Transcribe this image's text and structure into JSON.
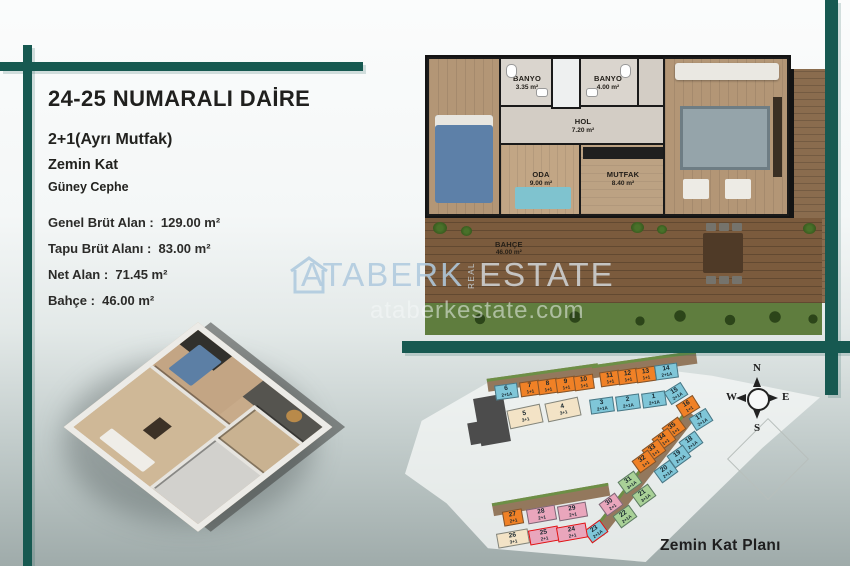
{
  "header": {
    "title": "24-25 NUMARALI DAİRE",
    "subtitle1": "2+1(Ayrı Mutfak)",
    "subtitle2": "Zemin Kat",
    "subtitle3": "Güney Cephe",
    "details": [
      {
        "label": "Genel Brüt Alan",
        "value": "129.00 m²"
      },
      {
        "label": "Tapu Brüt Alanı",
        "value": "83.00 m²"
      },
      {
        "label": "Net Alan",
        "value": "71.45 m²"
      },
      {
        "label": "Bahçe",
        "value": "46.00 m²"
      }
    ]
  },
  "colors": {
    "accent_teal": "#175951",
    "unit_teal": "#7fc6d8",
    "unit_orange": "#f08126",
    "unit_beige": "#f3e3c6",
    "unit_green": "#a9d197",
    "unit_pink": "#e9a6bc",
    "highlight_red": "#e01212"
  },
  "floor_plan": {
    "rooms": [
      {
        "name": "YATAK ODASI",
        "area": "17.90 m²",
        "floor": "wood",
        "x": 0,
        "y": 0,
        "w": 72,
        "h": 155
      },
      {
        "name": "BANYO",
        "area": "3.35 m²",
        "floor": "tile",
        "x": 72,
        "y": 0,
        "w": 52,
        "h": 48
      },
      {
        "name": "BANYO",
        "area": "4.00 m²",
        "floor": "tile",
        "x": 150,
        "y": 0,
        "w": 58,
        "h": 48
      },
      {
        "name": "HOL",
        "area": "7.20 m²",
        "floor": "hall",
        "x": 72,
        "y": 48,
        "w": 164,
        "h": 38
      },
      {
        "name": "ODA",
        "area": "9.00 m²",
        "floor": "wood2",
        "x": 72,
        "y": 86,
        "w": 80,
        "h": 69
      },
      {
        "name": "MUTFAK",
        "area": "8.40 m²",
        "floor": "kitchen",
        "x": 152,
        "y": 86,
        "w": 84,
        "h": 69
      },
      {
        "name": "SALON",
        "area": "21.60 m²",
        "floor": "wood",
        "x": 236,
        "y": 0,
        "w": 122,
        "h": 155
      }
    ],
    "garden": {
      "name": "BAHÇE",
      "area": "46.00 m²"
    }
  },
  "watermark": {
    "brand1": "ATABERK",
    "vertical": "REAL",
    "brand2": "ESTATE",
    "domain": "ataberkestate.com"
  },
  "site_plan": {
    "caption": "Zemin Kat Planı",
    "compass": {
      "n": "N",
      "e": "E",
      "s": "S",
      "w": "W"
    },
    "units": [
      {
        "num": "6",
        "type": "2+1A",
        "c": "teal",
        "x": 495,
        "y": 384,
        "r": -8,
        "w": 23
      },
      {
        "num": "7",
        "type": "1+1",
        "c": "orange",
        "x": 520,
        "y": 381,
        "r": -8
      },
      {
        "num": "8",
        "type": "1+1",
        "c": "orange",
        "x": 538,
        "y": 379,
        "r": -8
      },
      {
        "num": "9",
        "type": "1+1",
        "c": "orange",
        "x": 556,
        "y": 377,
        "r": -8
      },
      {
        "num": "10",
        "type": "1+1",
        "c": "orange",
        "x": 574,
        "y": 375,
        "r": -8
      },
      {
        "num": "11",
        "type": "1+1",
        "c": "orange",
        "x": 600,
        "y": 371,
        "r": -8
      },
      {
        "num": "12",
        "type": "1+1",
        "c": "orange",
        "x": 618,
        "y": 369,
        "r": -8
      },
      {
        "num": "13",
        "type": "1+1",
        "c": "orange",
        "x": 636,
        "y": 367,
        "r": -8
      },
      {
        "num": "14",
        "type": "2+1A",
        "c": "teal",
        "x": 655,
        "y": 364,
        "r": -8,
        "w": 23
      },
      {
        "num": "3",
        "type": "2+1A",
        "c": "teal",
        "x": 590,
        "y": 398,
        "r": -8,
        "w": 24
      },
      {
        "num": "2",
        "type": "2+1A",
        "c": "teal",
        "x": 616,
        "y": 395,
        "r": -8,
        "w": 24
      },
      {
        "num": "1",
        "type": "2+1A",
        "c": "teal",
        "x": 642,
        "y": 392,
        "r": -8,
        "w": 24
      },
      {
        "num": "5",
        "type": "3+1",
        "c": "beige",
        "x": 508,
        "y": 407,
        "r": -12,
        "w": 34,
        "h": 19
      },
      {
        "num": "4",
        "type": "3+1",
        "c": "beige",
        "x": 546,
        "y": 400,
        "r": -12,
        "w": 34,
        "h": 19
      },
      {
        "num": "15",
        "type": "2+1A",
        "c": "teal",
        "x": 666,
        "y": 386,
        "r": -32
      },
      {
        "num": "16",
        "type": "1+1",
        "c": "orange",
        "x": 678,
        "y": 399,
        "r": -32
      },
      {
        "num": "17",
        "type": "2+1A",
        "c": "teal",
        "x": 691,
        "y": 412,
        "r": -32
      },
      {
        "num": "35",
        "type": "1+1",
        "c": "orange",
        "x": 664,
        "y": 421,
        "r": -36
      },
      {
        "num": "34",
        "type": "1+1",
        "c": "orange",
        "x": 654,
        "y": 432,
        "r": -36
      },
      {
        "num": "33",
        "type": "1+1",
        "c": "orange",
        "x": 644,
        "y": 443,
        "r": -36
      },
      {
        "num": "32",
        "type": "1+1",
        "c": "orange",
        "x": 634,
        "y": 454,
        "r": -36
      },
      {
        "num": "18",
        "type": "2+1A",
        "c": "teal",
        "x": 681,
        "y": 435,
        "r": -36
      },
      {
        "num": "19",
        "type": "2+1A",
        "c": "teal",
        "x": 669,
        "y": 449,
        "r": -36
      },
      {
        "num": "20",
        "type": "2+1A",
        "c": "teal",
        "x": 656,
        "y": 464,
        "r": -36
      },
      {
        "num": "31",
        "type": "3+1A",
        "c": "green",
        "x": 620,
        "y": 475,
        "r": -36
      },
      {
        "num": "21",
        "type": "3+1A",
        "c": "green",
        "x": 634,
        "y": 488,
        "r": -36
      },
      {
        "num": "30",
        "type": "2+1",
        "c": "pink",
        "x": 601,
        "y": 497,
        "r": -36
      },
      {
        "num": "22",
        "type": "2+1A",
        "c": "green",
        "x": 615,
        "y": 509,
        "r": -36
      },
      {
        "num": "23",
        "type": "2+1A",
        "c": "teal",
        "x": 586,
        "y": 524,
        "r": -36,
        "hl": true
      },
      {
        "num": "27",
        "type": "2+1",
        "c": "orange",
        "x": 503,
        "y": 510,
        "r": -10
      },
      {
        "num": "28",
        "type": "2+1",
        "c": "pink",
        "x": 527,
        "y": 507,
        "r": -10,
        "w": 29
      },
      {
        "num": "29",
        "type": "2+1",
        "c": "pink",
        "x": 558,
        "y": 504,
        "r": -10,
        "w": 29
      },
      {
        "num": "26",
        "type": "3+1",
        "c": "beige",
        "x": 497,
        "y": 531,
        "r": -10,
        "w": 32
      },
      {
        "num": "25",
        "type": "2+1",
        "c": "pink",
        "x": 529,
        "y": 528,
        "r": -10,
        "w": 30,
        "hl": true
      },
      {
        "num": "24",
        "type": "2+1",
        "c": "pink",
        "x": 557,
        "y": 525,
        "r": -10,
        "w": 30,
        "hl": true
      }
    ]
  }
}
